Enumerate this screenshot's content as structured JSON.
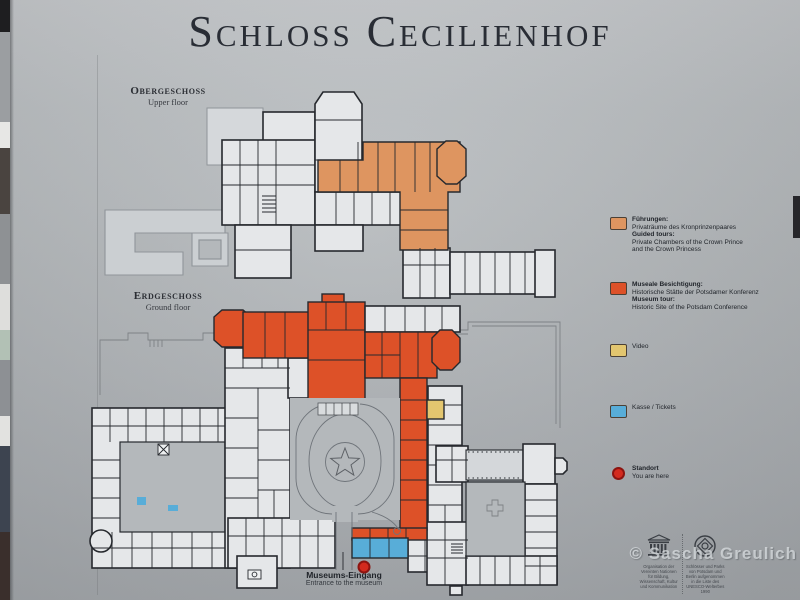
{
  "title": "Schloss Cecilienhof",
  "colors": {
    "guided_tours": "#DE9560",
    "museum_tour": "#DD5128",
    "video": "#E3C66F",
    "tickets": "#58ADD8",
    "standort": "#D32A1E"
  },
  "floors": {
    "upper": {
      "de": "Obergeschoss",
      "en": "Upper floor"
    },
    "ground": {
      "de": "Erdgeschoss",
      "en": "Ground floor"
    }
  },
  "legend": {
    "guided": {
      "title_de": "Führungen:",
      "line_de": "Privaträume des Kronprinzenpaares",
      "title_en": "Guided tours:",
      "line_en1": "Private Chambers of the Crown Prince",
      "line_en2": "and the Crown Princess"
    },
    "museum": {
      "title_de": "Museale Besichtigung:",
      "line_de": "Historische Stätte der Potsdamer Konferenz",
      "title_en": "Museum tour:",
      "line_en": "Historic Site of the Potsdam Conference"
    },
    "video": {
      "label": "Video"
    },
    "tickets": {
      "label": "Kasse / Tickets"
    },
    "standort": {
      "de": "Standort",
      "en": "You are here"
    }
  },
  "entrance": {
    "de": "Museums-Eingang",
    "en": "Entrance to the museum"
  },
  "footer": {
    "unesco_caption": "Organisation der Vereinten Nationen für Bildung, Wissenschaft, Kultur und Kommunikation",
    "heritage_caption": "Schlösser und Parks von Potsdam und Berlin aufgenommen in die Liste des UNESCO-Welterbes 1990",
    "watermark": "© Sascha Greulich"
  }
}
